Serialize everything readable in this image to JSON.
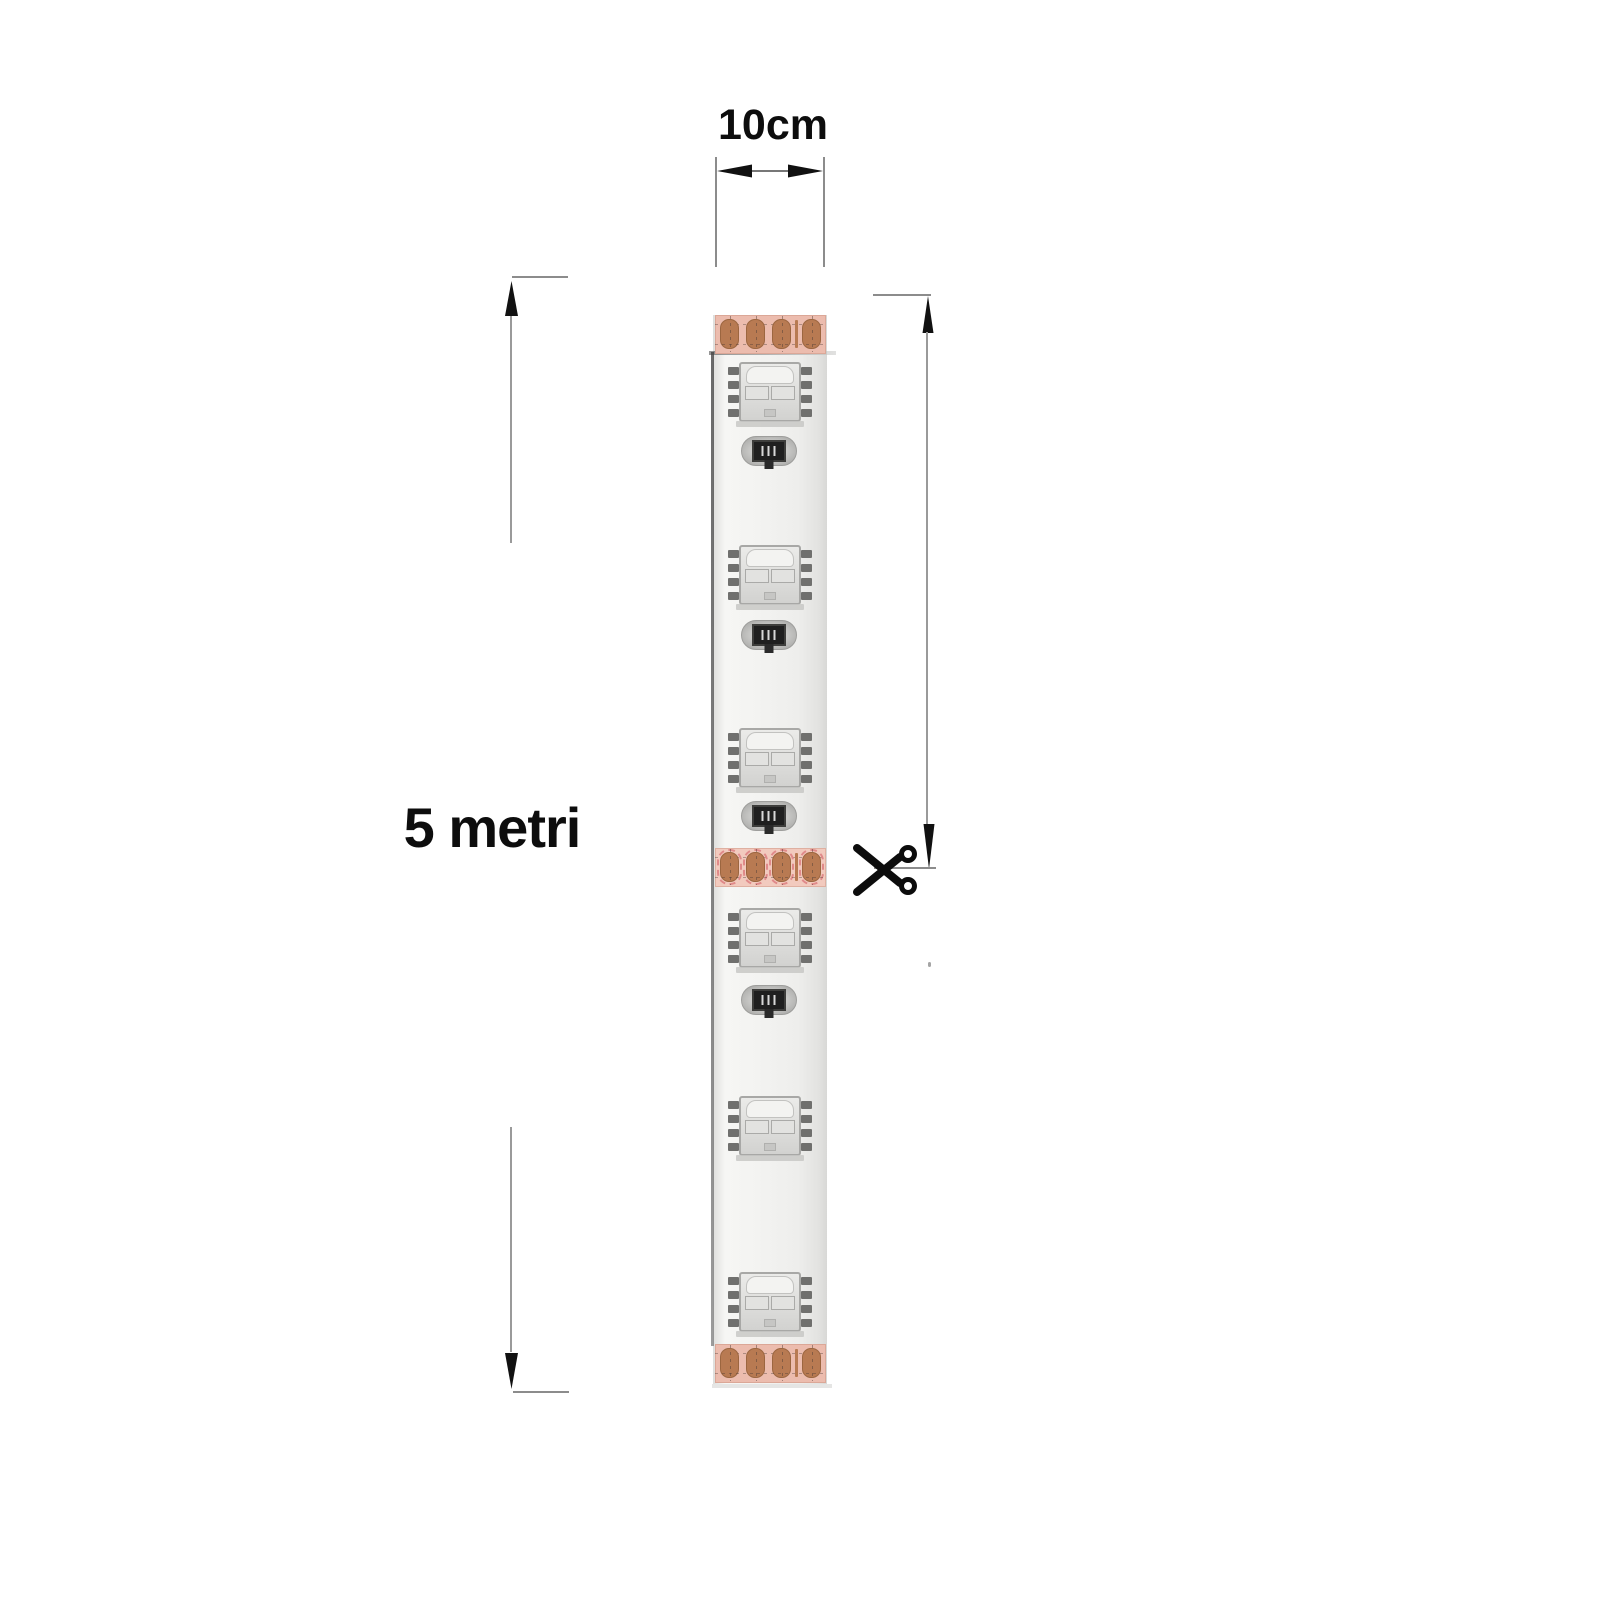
{
  "labels": {
    "width_dimension": "10cm",
    "length_dimension": "5 metri"
  },
  "icons": {
    "cut_marker": "scissors-icon",
    "dimension_arrows": [
      "double-arrow-horizontal-icon",
      "arrow-up-icon",
      "arrow-down-icon"
    ]
  },
  "diagram": {
    "type": "led-strip-cut-diagram",
    "strip": {
      "led_count": 6,
      "resistor_count": 4,
      "solder_pad_group_count": 3,
      "pads_per_group": 4,
      "led_y": [
        362,
        545,
        728,
        908,
        1096,
        1272
      ],
      "resistor_y": [
        436,
        620,
        801,
        985
      ],
      "pad_group_y": [
        315,
        848,
        1344
      ],
      "pad_group_types": [
        "end",
        "cut",
        "end"
      ]
    },
    "colors": {
      "copper_pad": "#b87a52",
      "pad_section_bg": "#ecbcae",
      "cut_section_bg": "#f2cabe",
      "cut_outline": "#e08a8a",
      "strip_body": "#f2f2f0",
      "strip_edge": "#4f4f4f",
      "dimension_line": "#8c8c8c",
      "arrow": "#111111",
      "text": "#0d0d0d"
    }
  }
}
